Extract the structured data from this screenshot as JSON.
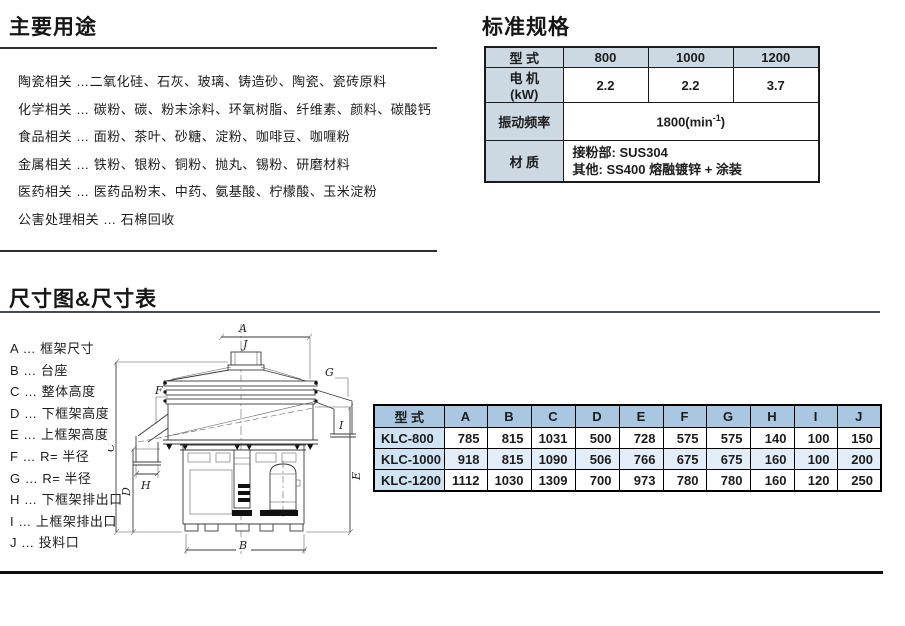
{
  "main_uses": {
    "title": "主要用途",
    "items": [
      "陶瓷相关 …二氧化硅、石灰、玻璃、铸造砂、陶瓷、瓷砖原料",
      "化学相关 … 碳粉、碳、粉末涂料、环氧树脂、纤维素、颜料、碳酸钙",
      "食品相关 … 面粉、茶叶、砂糖、淀粉、咖啡豆、咖喱粉",
      "金属相关 … 铁粉、银粉、铜粉、抛丸、锡粉、研磨材料",
      "医药相关 … 医药品粉末、中药、氨基酸、柠檬酸、玉米淀粉",
      "公害处理相关 … 石棉回收"
    ]
  },
  "spec": {
    "title": "标准规格",
    "header": {
      "label": "型  式",
      "m1": "800",
      "m2": "1000",
      "m3": "1200"
    },
    "motor": {
      "label": "电 机",
      "unit": "(kW)",
      "v1": "2.2",
      "v2": "2.2",
      "v3": "3.7"
    },
    "vibration": {
      "label": "振动频率",
      "value": "1800(min",
      "sup": "-1",
      "close": ")"
    },
    "material": {
      "label": "材  质",
      "line1": "接粉部: SUS304",
      "line2": "其他: SS400 熔融镀锌 + 涂装"
    },
    "colors": {
      "header_bg": "#ccd9e2",
      "border": "#1a1a1a"
    }
  },
  "dims": {
    "title": "尺寸图&尺寸表",
    "legend": [
      "A … 框架尺寸",
      "B … 台座",
      "C … 整体高度",
      "D … 下框架高度",
      "E … 上框架高度",
      "F … R= 半径",
      "G … R= 半径",
      "H … 下框架排出口",
      "I … 上框架排出口",
      "J … 投料口"
    ],
    "table": {
      "headers": [
        "型  式",
        "A",
        "B",
        "C",
        "D",
        "E",
        "F",
        "G",
        "H",
        "I",
        "J"
      ],
      "rows": [
        {
          "model": "KLC-800",
          "v": [
            "785",
            "815",
            "1031",
            "500",
            "728",
            "575",
            "575",
            "140",
            "100",
            "150"
          ]
        },
        {
          "model": "KLC-1000",
          "v": [
            "918",
            "815",
            "1090",
            "506",
            "766",
            "675",
            "675",
            "160",
            "100",
            "200"
          ]
        },
        {
          "model": "KLC-1200",
          "v": [
            "1112",
            "1030",
            "1309",
            "700",
            "973",
            "780",
            "780",
            "160",
            "120",
            "250"
          ]
        }
      ],
      "colors": {
        "header_bg": "#a9c7e1",
        "model_bg": "#cfe3f2",
        "alt_row_bg": "#e2edf8"
      }
    }
  },
  "diagram": {
    "labels": {
      "A": "A",
      "B": "B",
      "C": "C",
      "D": "D",
      "E": "E",
      "F": "F",
      "G": "G",
      "H": "H",
      "I": "I",
      "J": "J"
    }
  }
}
